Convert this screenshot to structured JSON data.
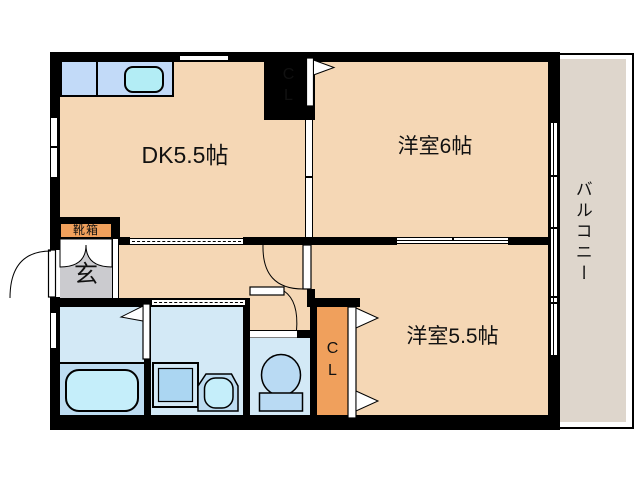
{
  "title": "apartment-floor-plan",
  "rooms": {
    "dk": {
      "label": "DK5.5帖"
    },
    "western6": {
      "label": "洋室6帖"
    },
    "western55": {
      "label": "洋室5.5帖"
    },
    "balcony": {
      "label": "バルコニー"
    },
    "entrance": {
      "label": "玄"
    },
    "shoe_box": {
      "label": "靴箱"
    },
    "closet_top": {
      "label": "C\nL"
    },
    "closet_bottom": {
      "label": "C\nL"
    }
  },
  "colors": {
    "wall": "#000000",
    "floor": "#f5d7b5",
    "balcony_floor": "#ded6cc",
    "closet": "#f0a05c",
    "entrance_floor": "#cbcbcf",
    "wet_room_floor": "#d3e9f6",
    "fixture_blue": "#b9daf3",
    "kitchen_counter": "#c2daf8",
    "sink_cyan": "#b3edf5",
    "tub_surround": "#bddcf1"
  }
}
